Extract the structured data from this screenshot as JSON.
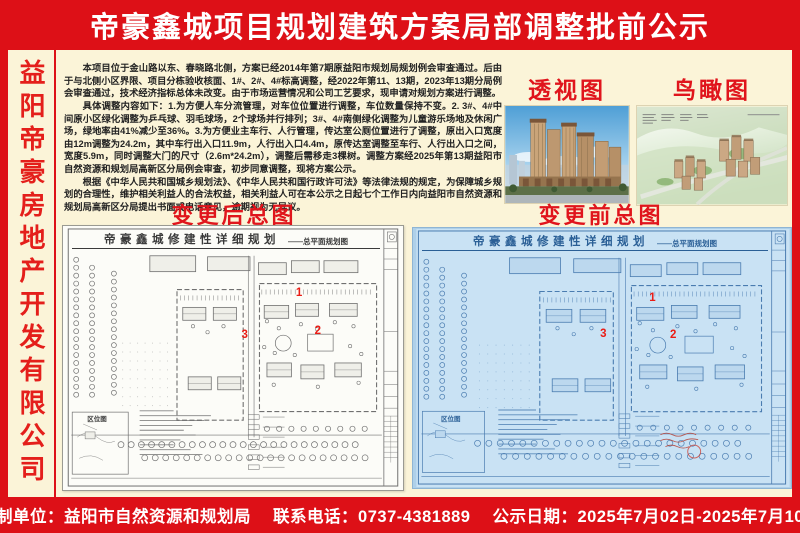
{
  "title": "帝豪鑫城项目规划建筑方案局部调整批前公示",
  "sidebar": {
    "company": "益阳帝豪房地产开发有限公司"
  },
  "notice": {
    "p1": "本项目位于金山路以东、春晓路北侧，方案已经2014年第7期原益阳市规划局规划例会审查通过。后由于与北侧小区界限、项目分栋验收核面、1#、2#、4#标高调整，经2022年第11、13期，2023年13期分局例会审查通过，技术经济指标总体未改变。由于市场运营情况和公司工艺要求，现申请对规划方案进行调整。",
    "p2": "具体调整内容如下：1.为方便人车分流管理，对车位位置进行调整，车位数量保持不变。2. 3#、4#中间原小区绿化调整为乒乓球、羽毛球场，2个球场并行排列；3#、4#南侧绿化调整为儿童游乐场地及休闲广场，绿地率由41%减少至36%。3.为方便业主车行、人行管理，传达室公厕位置进行了调整，原出入口宽度由12m调整为24.2m，其中车行出入口11.9m，人行出入口4.4m，原传达室调整至车行、人行出入口之间，宽度5.9m，同时调整大门的尺寸（2.6m*24.2m），调整后需移走3棵树。调整方案经2025年第13期益阳市自然资源和规划局高新区分局例会审查，初步同意调整，现将方案公示。",
    "p3": "根据《中华人民共和国城乡规划法》、《中华人民共和国行政许可法》等法律法规的规定，为保障城乡规划的合理性，维护相关利益人的合法权益，相关利益人可在本公示之日起七个工作日内向益阳市自然资源和规划局高新区分局提出书面或电话意见，逾期视为无异议。"
  },
  "images": {
    "perspective_label": "透视图",
    "aerial_label": "鸟瞰图"
  },
  "plans": {
    "after_label": "变更后总图",
    "before_label": "变更前总图",
    "plan_title": "帝豪鑫城修建性详细规划",
    "plan_subtitle": "——总平面规划图",
    "location_map_label": "区位图",
    "markers": [
      "1",
      "2",
      "3"
    ]
  },
  "footer": {
    "supervisor": "监制单位：益阳市自然资源和规划局",
    "phone": "联系电话：0737-4381889",
    "dates": "公示日期：2025年7月02日-2025年7月10日"
  },
  "colors": {
    "banner_red": "#dd1017",
    "accent_red": "#e0151c",
    "cream": "#fbf4d8",
    "blueprint_blue": "#aed0e9"
  }
}
